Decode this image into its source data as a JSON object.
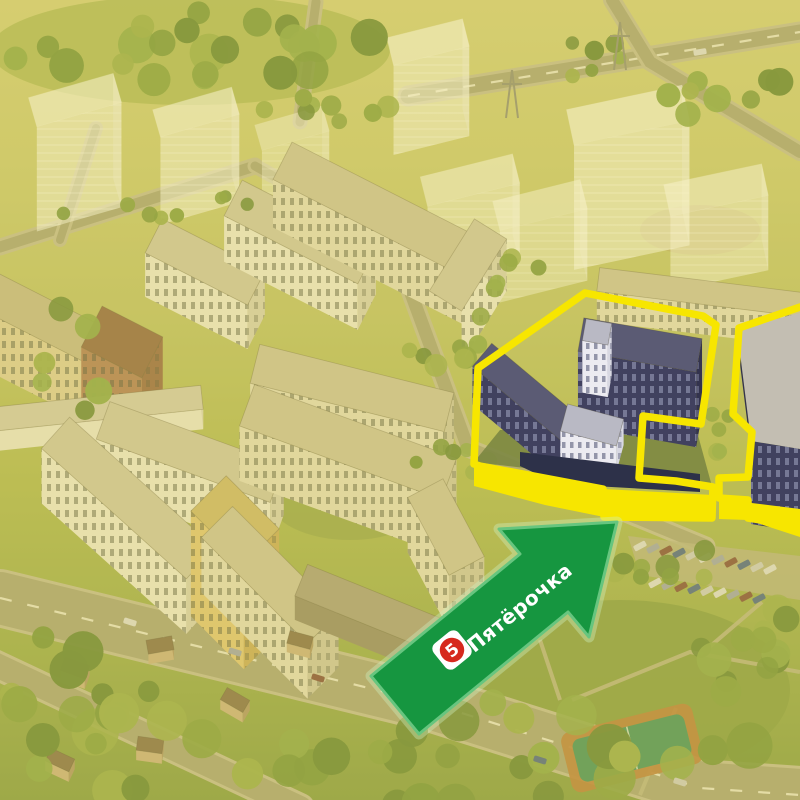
{
  "image": {
    "title": "Aerial render of residential complex with Pyaterochka store location highlighted"
  },
  "overlay": {
    "store_label": "Пятёрочка",
    "logo_digit": "5",
    "colors": {
      "highlight_yellow": "#f7e600",
      "arrow_green": "#169640",
      "arrow_edge": "#67c57f",
      "arrow_glow": "#cdeebd",
      "logo_red": "#d6291e",
      "logo_white": "#ffffff",
      "label_text": "#ffffff"
    },
    "arrow": {
      "points": "617,522 589,637 568,612 419,734 371,676 520,554 499,529",
      "label_x": 524,
      "label_y": 613,
      "label_rotate": -39,
      "badge_x": 452,
      "badge_y": 650,
      "badge_rotate": -39
    },
    "outline": {
      "left_path": "M585,293 L703,316 L716,325 L701,424 L643,416 L639,478 L676,481 L713,487 L712,518 L604,517 L603,489 L480,466 L474,464 L478,368 Z",
      "right_path": "M800,307 L739,328 L733,414 L752,432 L748,477 L719,478 L719,498 L748,500 L748,518 L800,526",
      "left_strip": "474,464 603,489 713,495 713,518 604,517 545,505 474,486",
      "right_strip": "719,499 800,509 800,537 748,520 719,519"
    }
  },
  "scene": {
    "tint": {
      "color": "#e9d44d",
      "opacity": 0.3
    },
    "sky_gradient": [
      "#cecb80",
      "#c6c677",
      "#b9bd6c",
      "#aab457",
      "#95a751",
      "#7f9747"
    ],
    "palette": {
      "road": "#a29f7c",
      "road_edge": "#bdb897",
      "path": "#b6b08a",
      "dash": "#f2f0e0",
      "tree_greens": [
        "#7d9a44",
        "#6f8f3e",
        "#86a44c",
        "#5f8038",
        "#93a84f"
      ],
      "car_colors": [
        "#d9d9d9",
        "#9aa0b0",
        "#7b4840",
        "#47608c",
        "#c8c8c8"
      ],
      "kinds": {
        "white": {
          "roof": "#c9c3a8",
          "face": "#e8e5d4",
          "end": "#d2cdb6",
          "win": "winL"
        },
        "cream": {
          "roof": "#c6bf9f",
          "face": "#ded8bf",
          "end": "#c8c2a6",
          "win": "winL"
        },
        "beige": {
          "roof": "#bfb58f",
          "face": "#d8cba0",
          "end": "#bfb27e",
          "win": "winL"
        },
        "yellow": {
          "roof": "#c8b470",
          "face": "#dcc27c",
          "end": "#c3a75f",
          "win": "winL"
        },
        "brown": {
          "roof": "#8a6248",
          "face": "#a9795c",
          "end": "#906349",
          "win": "winL"
        },
        "low": {
          "roof": "#cdc8b0",
          "face": "#e6e2d2",
          "end": "#d5d1bd",
          "win": null
        },
        "pod": {
          "roof": "#a39a80",
          "face": "#8e866c",
          "end": "#7e7660",
          "win": null
        },
        "house": {
          "roof": "#7e6a4e",
          "face": "#c4ad84",
          "end": "#a8916b",
          "win": null
        },
        "dark": {
          "roof": "#5b5b74",
          "face": "#41415f",
          "end": "#33334e",
          "win": "winD"
        },
        "hwhite": {
          "roof": "#b9b9c4",
          "face": "#ecebf1",
          "end": "#d8d8e2",
          "win": "winW"
        }
      }
    },
    "green_patches": [
      [
        190,
        50,
        200,
        55,
        "#a8b55e",
        0.9
      ],
      [
        320,
        250,
        70,
        35,
        "#95a653",
        0.8
      ],
      [
        350,
        500,
        80,
        40,
        "#8fa050",
        0.8
      ],
      [
        700,
        230,
        60,
        25,
        "#b3a06a",
        0.55
      ],
      [
        620,
        690,
        170,
        90,
        "#7f9747",
        0.9
      ]
    ],
    "roads": [
      {
        "pts": [
          [
            0,
            598
          ],
          [
            430,
            703
          ],
          [
            700,
            788
          ],
          [
            800,
            795
          ]
        ],
        "w": 52,
        "dash": true
      },
      {
        "pts": [
          [
            -10,
            662
          ],
          [
            300,
            808
          ]
        ],
        "w": 24
      },
      {
        "pts": [
          [
            408,
            96
          ],
          [
            800,
            32
          ]
        ],
        "w": 15,
        "dash": true
      },
      {
        "pts": [
          [
            612,
            0
          ],
          [
            650,
            62
          ],
          [
            800,
            152
          ]
        ],
        "w": 12
      },
      {
        "pts": [
          [
            0,
            247
          ],
          [
            255,
            166
          ]
        ],
        "w": 11
      },
      {
        "pts": [
          [
            316,
            2
          ],
          [
            300,
            122
          ]
        ],
        "w": 9
      },
      {
        "pts": [
          [
            398,
            258
          ],
          [
            468,
            448
          ],
          [
            706,
            546
          ]
        ],
        "w": 13
      },
      {
        "pts": [
          [
            255,
            166
          ],
          [
            420,
            258
          ]
        ],
        "w": 9
      },
      {
        "pts": [
          [
            96,
            128
          ],
          [
            60,
            240
          ]
        ],
        "w": 8
      }
    ],
    "foot_paths": [
      [
        [
          572,
          700
        ],
        [
          690,
          652
        ],
        [
          800,
          672
        ]
      ],
      [
        [
          640,
          795
        ],
        [
          676,
          708
        ]
      ],
      [
        [
          700,
          655
        ],
        [
          762,
          602
        ]
      ],
      [
        [
          540,
          640
        ],
        [
          560,
          700
        ]
      ]
    ],
    "ghosts": [
      {
        "cx": 75,
        "cy": 100,
        "len": 88,
        "wid": 30,
        "hgt": 105,
        "ang": -16,
        "op": 0.6
      },
      {
        "cx": 196,
        "cy": 112,
        "len": 82,
        "wid": 28,
        "hgt": 88,
        "ang": -16,
        "op": 0.6
      },
      {
        "cx": 292,
        "cy": 128,
        "len": 70,
        "wid": 26,
        "hgt": 55,
        "ang": -16,
        "op": 0.45
      },
      {
        "cx": 428,
        "cy": 42,
        "len": 78,
        "wid": 28,
        "hgt": 90,
        "ang": -14,
        "op": 0.6
      },
      {
        "cx": 470,
        "cy": 180,
        "len": 95,
        "wid": 30,
        "hgt": 80,
        "ang": -14,
        "op": 0.55
      },
      {
        "cx": 540,
        "cy": 205,
        "len": 90,
        "wid": 30,
        "hgt": 72,
        "ang": -14,
        "op": 0.5
      },
      {
        "cx": 628,
        "cy": 115,
        "len": 118,
        "wid": 36,
        "hgt": 125,
        "ang": -12,
        "op": 0.62
      },
      {
        "cx": 716,
        "cy": 190,
        "len": 100,
        "wid": 32,
        "hgt": 75,
        "ang": -12,
        "op": 0.55
      }
    ],
    "buildings": [
      {
        "cx": 205,
        "cy": 262,
        "len": 115,
        "wid": 38,
        "hgt": 44,
        "ang": 27,
        "kind": "white"
      },
      {
        "cx": 300,
        "cy": 232,
        "len": 150,
        "wid": 40,
        "hgt": 46,
        "ang": 27,
        "kind": "white"
      },
      {
        "cx": 385,
        "cy": 213,
        "len": 230,
        "wid": 42,
        "hgt": 48,
        "ang": 27,
        "kind": "cream"
      },
      {
        "cx": 468,
        "cy": 265,
        "len": 85,
        "wid": 38,
        "hgt": 52,
        "ang": -58,
        "kind": "white"
      },
      {
        "cx": 700,
        "cy": 292,
        "len": 205,
        "wid": 24,
        "hgt": 30,
        "ang": 7,
        "kind": "cream"
      },
      {
        "cx": 42,
        "cy": 318,
        "len": 115,
        "wid": 40,
        "hgt": 58,
        "ang": 27,
        "kind": "beige"
      },
      {
        "cx": 122,
        "cy": 342,
        "len": 68,
        "wid": 46,
        "hgt": 82,
        "ang": 27,
        "kind": "brown"
      },
      {
        "cx": 352,
        "cy": 388,
        "len": 200,
        "wid": 40,
        "hgt": 48,
        "ang": 14,
        "kind": "cream"
      },
      {
        "cx": 100,
        "cy": 408,
        "len": 205,
        "wid": 24,
        "hgt": 20,
        "ang": -6,
        "kind": "low"
      },
      {
        "cx": 190,
        "cy": 452,
        "len": 185,
        "wid": 40,
        "hgt": 50,
        "ang": 20,
        "kind": "white"
      },
      {
        "cx": 128,
        "cy": 498,
        "len": 195,
        "wid": 42,
        "hgt": 55,
        "ang": 42,
        "kind": "white"
      },
      {
        "cx": 348,
        "cy": 442,
        "len": 215,
        "wid": 44,
        "hgt": 55,
        "ang": 20,
        "kind": "cream"
      },
      {
        "cx": 446,
        "cy": 527,
        "len": 88,
        "wid": 40,
        "hgt": 55,
        "ang": 62,
        "kind": "cream"
      },
      {
        "cx": 235,
        "cy": 520,
        "len": 75,
        "wid": 50,
        "hgt": 105,
        "ang": 45,
        "kind": "yellow"
      },
      {
        "cx": 270,
        "cy": 575,
        "len": 150,
        "wid": 44,
        "hgt": 55,
        "ang": 45,
        "kind": "cream"
      },
      {
        "cx": 380,
        "cy": 612,
        "len": 170,
        "wid": 34,
        "hgt": 24,
        "ang": 22,
        "kind": "pod"
      }
    ],
    "houses": [
      {
        "cx": 75,
        "cy": 668,
        "len": 26,
        "wid": 14,
        "hgt": 10,
        "ang": 20,
        "kind": "house"
      },
      {
        "cx": 160,
        "cy": 645,
        "len": 26,
        "wid": 14,
        "hgt": 10,
        "ang": -10,
        "kind": "house"
      },
      {
        "cx": 235,
        "cy": 700,
        "len": 26,
        "wid": 14,
        "hgt": 10,
        "ang": 30,
        "kind": "house"
      },
      {
        "cx": 150,
        "cy": 745,
        "len": 26,
        "wid": 14,
        "hgt": 10,
        "ang": 8,
        "kind": "house"
      },
      {
        "cx": 60,
        "cy": 760,
        "len": 26,
        "wid": 14,
        "hgt": 10,
        "ang": 25,
        "kind": "house"
      },
      {
        "cx": 300,
        "cy": 640,
        "len": 24,
        "wid": 13,
        "hgt": 9,
        "ang": 15,
        "kind": "house"
      }
    ],
    "tree_clusters": [
      [
        190,
        45,
        190,
        40,
        22,
        10,
        20
      ],
      [
        330,
        105,
        80,
        18,
        8,
        7,
        12
      ],
      [
        735,
        95,
        70,
        35,
        8,
        8,
        14
      ],
      [
        150,
        205,
        120,
        15,
        8,
        6,
        10
      ],
      [
        430,
        330,
        60,
        45,
        8,
        7,
        12
      ],
      [
        455,
        468,
        55,
        22,
        6,
        6,
        10
      ],
      [
        722,
        432,
        14,
        42,
        5,
        6,
        9
      ],
      [
        745,
        645,
        65,
        50,
        12,
        10,
        19
      ],
      [
        400,
        756,
        400,
        55,
        30,
        12,
        24
      ],
      [
        95,
        695,
        105,
        70,
        14,
        10,
        22
      ],
      [
        650,
        560,
        90,
        22,
        8,
        8,
        13
      ],
      [
        598,
        62,
        60,
        22,
        6,
        6,
        10
      ],
      [
        70,
        360,
        40,
        60,
        6,
        8,
        14
      ],
      [
        505,
        260,
        40,
        30,
        5,
        6,
        10
      ]
    ],
    "court": {
      "x": 632,
      "y": 748,
      "w": 135,
      "h": 62,
      "rot": -14,
      "outer": "#b5793f",
      "inner": "#3f8d60",
      "line": "#e8e8d8"
    },
    "parking": {
      "pad": "628,536 800,556 800,600 640,575",
      "pad_color": "#b3ae8a",
      "rows": [
        {
          "x": 640,
          "y": 546,
          "n": 11,
          "step": 13,
          "dy": 0.18
        },
        {
          "x": 655,
          "y": 583,
          "n": 9,
          "step": 13,
          "dy": 0.15
        }
      ]
    },
    "road_cars": [
      [
        130,
        622,
        17
      ],
      [
        235,
        652,
        17
      ],
      [
        318,
        678,
        17
      ],
      [
        540,
        760,
        17
      ],
      [
        680,
        782,
        17
      ],
      [
        700,
        52,
        -9
      ]
    ],
    "pylons": [
      [
        512,
        70
      ],
      [
        620,
        22
      ]
    ],
    "highlight": {
      "court": "500,430 696,428 713,490 474,462",
      "court_color": "#7c8742",
      "slabs": [
        {
          "cx": 640,
          "cy": 345,
          "len": 120,
          "wid": 34,
          "hgt": 75,
          "ang": 10,
          "kind": "dark"
        },
        {
          "cx": 597,
          "cy": 332,
          "len": 26,
          "wid": 22,
          "hgt": 52,
          "ang": 10,
          "kind": "hwhite"
        },
        {
          "cx": 530,
          "cy": 395,
          "len": 125,
          "wid": 30,
          "hgt": 38,
          "ang": 40,
          "kind": "dark"
        },
        {
          "cx": 592,
          "cy": 425,
          "len": 58,
          "wid": 28,
          "hgt": 26,
          "ang": 15,
          "kind": "hwhite"
        }
      ],
      "base_strip": "520,452 700,474 700,492 558,484 520,466",
      "base_color": "#2d3149",
      "right_roof": "737,329 800,313 800,449 751,441",
      "right_roof_color": "#c3beb2",
      "right_face": "737,329 751,441 751,452 737,340",
      "right_body": "751,441 800,449 800,532 751,524"
    }
  }
}
